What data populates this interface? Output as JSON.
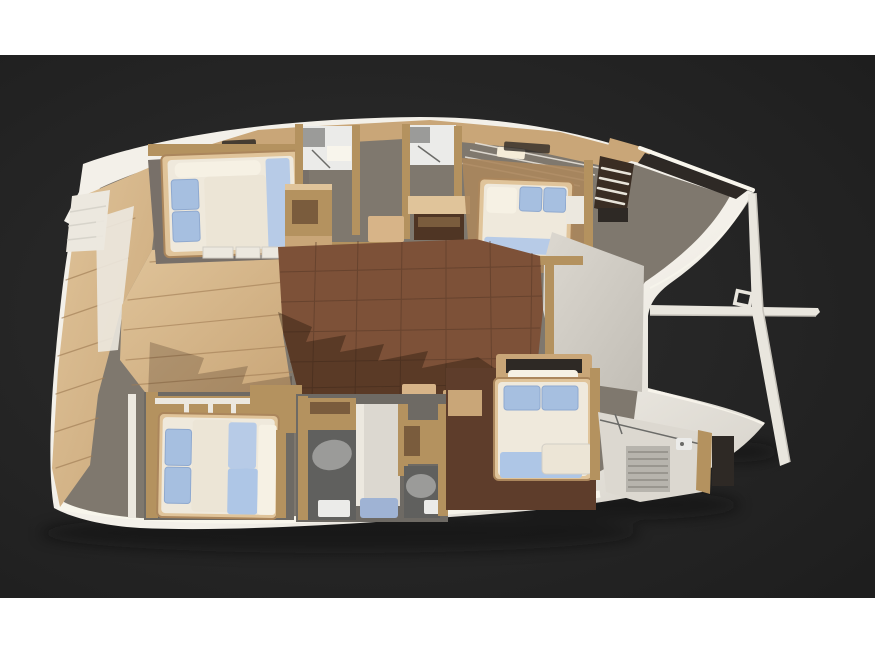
{
  "scene": {
    "description": "Top-down 3D cutaway render of a catamaran sailing yacht interior layout: four double cabins with blue pillows, bathrooms with shower trays, central saloon with dark wood floor, teak side decks, bow crossbeam and bowsprit. Rendered on a dark charcoal band with white margins above and below.",
    "strip_top_height": 55,
    "band_height": 543,
    "strip_bottom_height": 58
  },
  "palette": {
    "page_bg": "#ffffff",
    "band_inner": "#2e2e2e",
    "band_outer": "#1d1d1d",
    "boat_shadow": "#0e0e0e",
    "hull_light": "#f3f0e9",
    "hull_dark": "#d2cec6",
    "hull_rim": "#f8f5ec",
    "bridge_light": "#dcd8d0",
    "bridge_dark": "#c2beb6",
    "floor_base": "#7f786e",
    "deck": "#c9a678",
    "deck_light": "#e0c49a",
    "deck_dark": "#ab865c",
    "deck_line": "#a07c54",
    "trim_white": "#ece8df",
    "wall_wood": "#b4925f",
    "wall_wood_dark": "#8a6844",
    "cabinet_wood": "#c9a678",
    "cabinet_dark": "#7a5c3d",
    "furniture_dark": "#4f3524",
    "saloon_floor": "#7d5138",
    "saloon_line": "#5e3d2b",
    "saloon_step": "#d7b488",
    "shadow_overlay": "rgba(35,20,10,0.38)",
    "shadow_overlay2": "rgba(35,20,10,0.22)",
    "floor_gray": "#787069",
    "floor_gray_dark": "#6e6a64",
    "bath_floor": "#60605e",
    "bath_oval": "#9b9b99",
    "fixture_white": "#ebebe9",
    "mattress": "#efe9dc",
    "bolster": "#f6f1e4",
    "duvet": "#ece5d6",
    "pillow_blue": "#a6bfe0",
    "pillow_edge": "#8fa9cf",
    "blanket_blue": "#b7cbe7",
    "blanket_blue2": "#aec6e6",
    "shower_tray_blue": "#9fb3d4",
    "ladder_dark": "#3a2d23",
    "rung_light": "#e8e4da",
    "opening_dark": "#2e2925",
    "glass_line": "#6b6b68",
    "slat": "#b7b4ad",
    "slat_line": "#8f8c85",
    "spar": "#e9e6de",
    "spar_shade": "#c7c3bb",
    "skylight": "#f5ecd8"
  }
}
